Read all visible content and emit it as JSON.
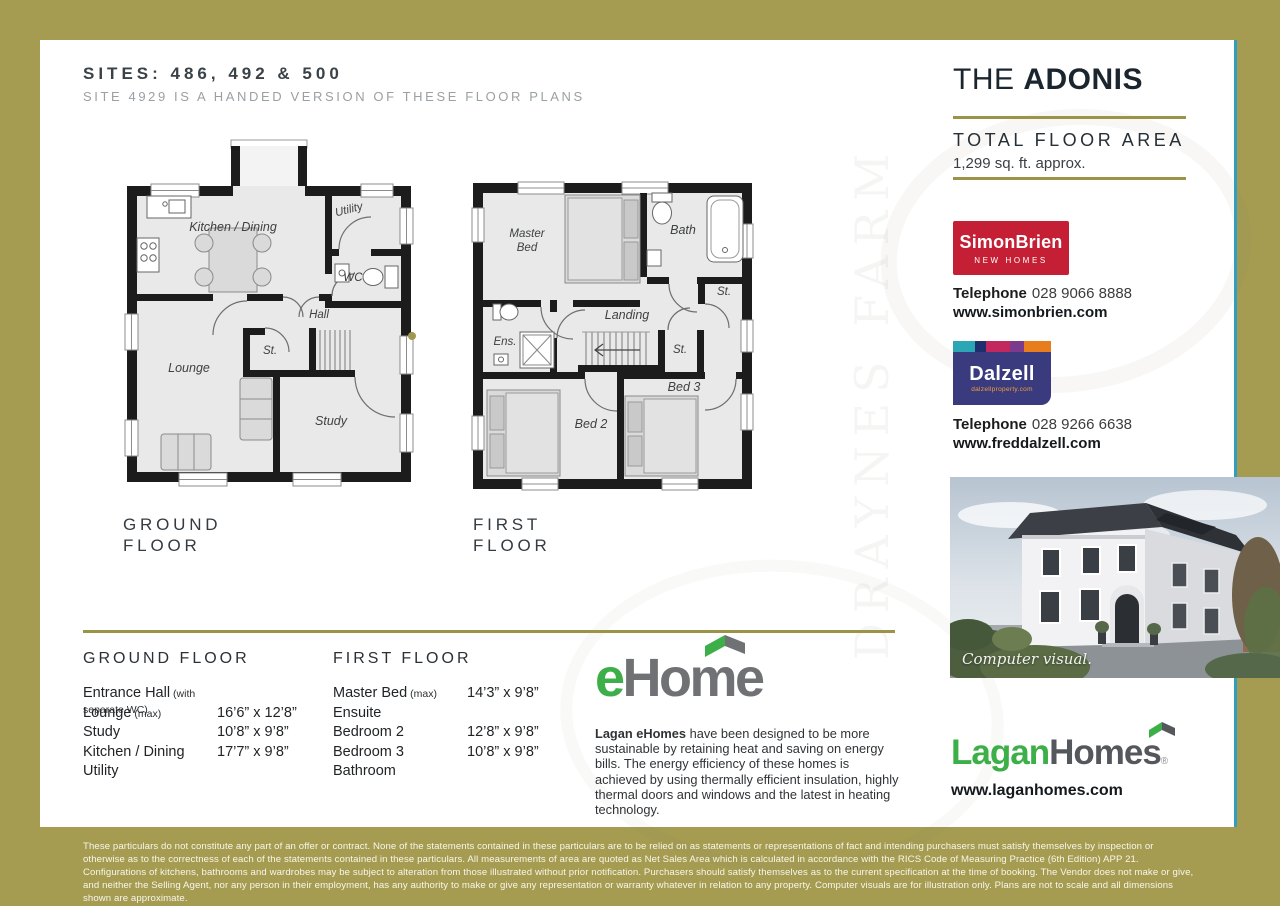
{
  "header": {
    "sites_title": "SITES: 486, 492 & 500",
    "sites_subtitle": "SITE 4929 IS A HANDED VERSION OF THESE FLOOR PLANS"
  },
  "plans": {
    "ground": {
      "caption_line1": "GROUND",
      "caption_line2": "FLOOR",
      "labels": {
        "kitchen": "Kitchen / Dining",
        "utility": "Utility",
        "wc": "WC",
        "hall": "Hall",
        "store": "St.",
        "lounge": "Lounge",
        "study": "Study"
      }
    },
    "first": {
      "caption_line1": "FIRST",
      "caption_line2": "FLOOR",
      "labels": {
        "master": "Master Bed",
        "bath": "Bath",
        "store_right": "St.",
        "landing": "Landing",
        "ensuite": "Ens.",
        "store_mid": "St.",
        "bed2": "Bed 2",
        "bed3": "Bed 3"
      }
    }
  },
  "sidebar": {
    "title_prefix": "THE ",
    "title_name": "ADONIS",
    "area_label": "TOTAL FLOOR AREA",
    "area_value": "1,299 sq. ft. approx.",
    "agent_simonbrien": {
      "name": "SimonBrien",
      "tagline": "NEW HOMES",
      "phone_label": "Telephone",
      "phone_number": "028 9066 8888",
      "website": "www.simonbrien.com",
      "brand_color": "#c51f35"
    },
    "agent_dalzell": {
      "name": "Dalzell",
      "tagline": "dalzellproperty.com",
      "phone_label": "Telephone",
      "phone_number": "028 9266 6638",
      "website": "www.freddalzell.com",
      "brand_color": "#3a3a7e"
    },
    "photo_caption": "Computer visual.",
    "lagan": {
      "word1": "Lagan",
      "word2": "Homes",
      "registered": "®",
      "website": "www.laganhomes.com",
      "brand_green": "#3daf49"
    }
  },
  "specs": {
    "ground": {
      "heading": "GROUND FLOOR",
      "rows": [
        {
          "room": "Entrance Hall",
          "note": "(with separate WC)",
          "dim": ""
        },
        {
          "room": "Lounge",
          "note": "(max)",
          "dim": "16’6” x 12’8”"
        },
        {
          "room": "Study",
          "note": "",
          "dim": "10’8” x 9’8”"
        },
        {
          "room": "Kitchen / Dining",
          "note": "",
          "dim": "17’7” x 9’8”"
        },
        {
          "room": "Utility",
          "note": "",
          "dim": ""
        }
      ]
    },
    "first": {
      "heading": "FIRST FLOOR",
      "rows": [
        {
          "room": "Master Bed",
          "note": "(max)",
          "dim": "14’3” x 9’8”"
        },
        {
          "room": "Ensuite",
          "note": "",
          "dim": ""
        },
        {
          "room": "Bedroom 2",
          "note": "",
          "dim": "12’8” x 9’8”"
        },
        {
          "room": "Bedroom 3",
          "note": "",
          "dim": "10’8” x 9’8”"
        },
        {
          "room": "Bathroom",
          "note": "",
          "dim": ""
        }
      ]
    }
  },
  "ehome": {
    "logo_e": "e",
    "logo_rest": "Home",
    "body_lead": "Lagan eHomes",
    "body_rest": " have been designed to be more sustainable by retaining heat and saving on energy bills. The energy efficiency of these homes is achieved by using thermally efficient insulation, highly thermal doors and windows and the latest in heating technology."
  },
  "footer": {
    "disclaimer": "These particulars do not constitute any part of an offer or contract. None of the statements contained in these particulars are to be relied on as statements or representations of fact and intending purchasers must satisfy themselves by inspection or otherwise as to the correctness of each of the statements contained in these particulars. All measurements of area are quoted as Net Sales Area which is calculated in accordance with the RICS Code of Measuring Practice (6th Edition) APP 21. Configurations of kitchens, bathrooms and wardrobes may be subject to alteration from those illustrated without prior notification. Purchasers should satisfy themselves as to the current specification at the time of booking. The Vendor does not make or give, and neither the Selling Agent, nor any person in their employment, has any authority to make or give any representation or warranty whatever in relation to any property. Computer visuals are for illustration only. Plans are not to scale and all dimensions shown are approximate."
  },
  "watermark": {
    "text": "DRAYNES FARM"
  },
  "colors": {
    "page_olive": "#a59c52",
    "divider_teal": "#2f9fc0",
    "rule_olive": "#9b9347"
  }
}
